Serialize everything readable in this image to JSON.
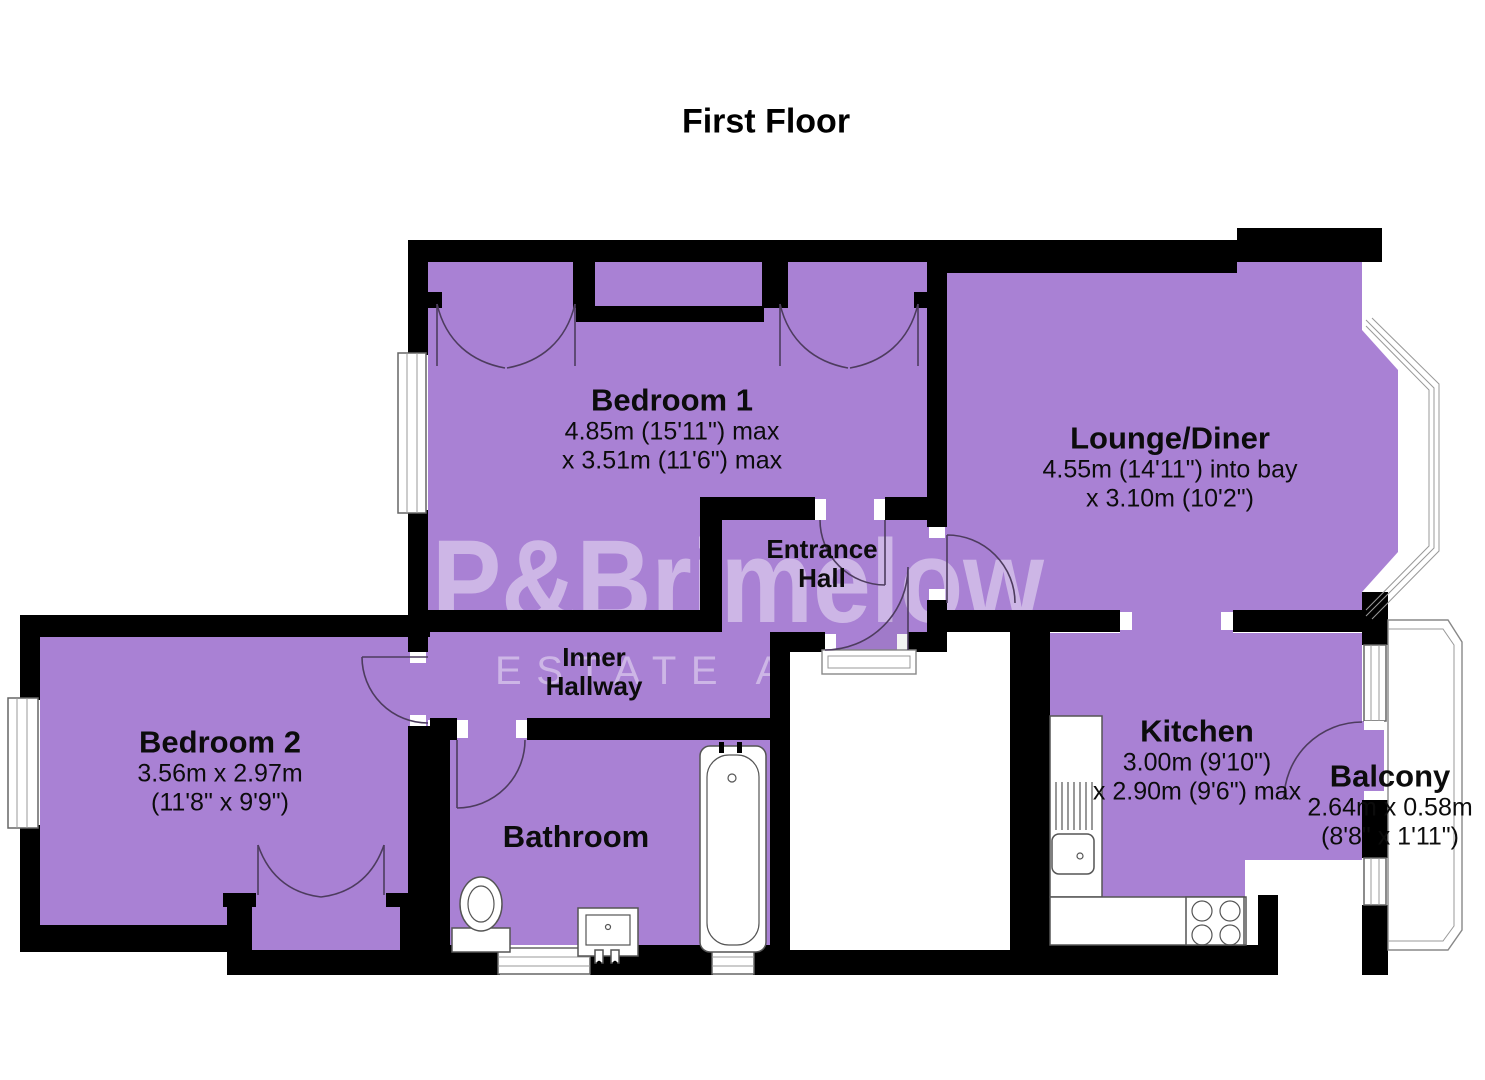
{
  "title": "First Floor",
  "watermark": {
    "line1": "P&Brimelow",
    "line2": "ESTATE AGENTS"
  },
  "colors": {
    "room_fill": "#a981d4",
    "wall": "#000000",
    "watermark": "#ffffff"
  },
  "rooms": {
    "bedroom1": {
      "name": "Bedroom 1",
      "dim1": "4.85m (15'11\") max",
      "dim2": "x 3.51m (11'6\") max"
    },
    "lounge": {
      "name": "Lounge/Diner",
      "dim1": "4.55m (14'11\") into bay",
      "dim2": "x 3.10m (10'2\")"
    },
    "entrance_hall": {
      "name1": "Entrance",
      "name2": "Hall"
    },
    "inner_hallway": {
      "name1": "Inner",
      "name2": "Hallway"
    },
    "bedroom2": {
      "name": "Bedroom 2",
      "dim1": "3.56m x 2.97m",
      "dim2": "(11'8\" x 9'9\")"
    },
    "bathroom": {
      "name": "Bathroom"
    },
    "kitchen": {
      "name": "Kitchen",
      "dim1": "3.00m (9'10\")",
      "dim2": "x 2.90m (9'6\") max"
    },
    "balcony": {
      "name": "Balcony",
      "dim1": "2.64m x 0.58m",
      "dim2": "(8'8\" x 1'11\")"
    }
  }
}
